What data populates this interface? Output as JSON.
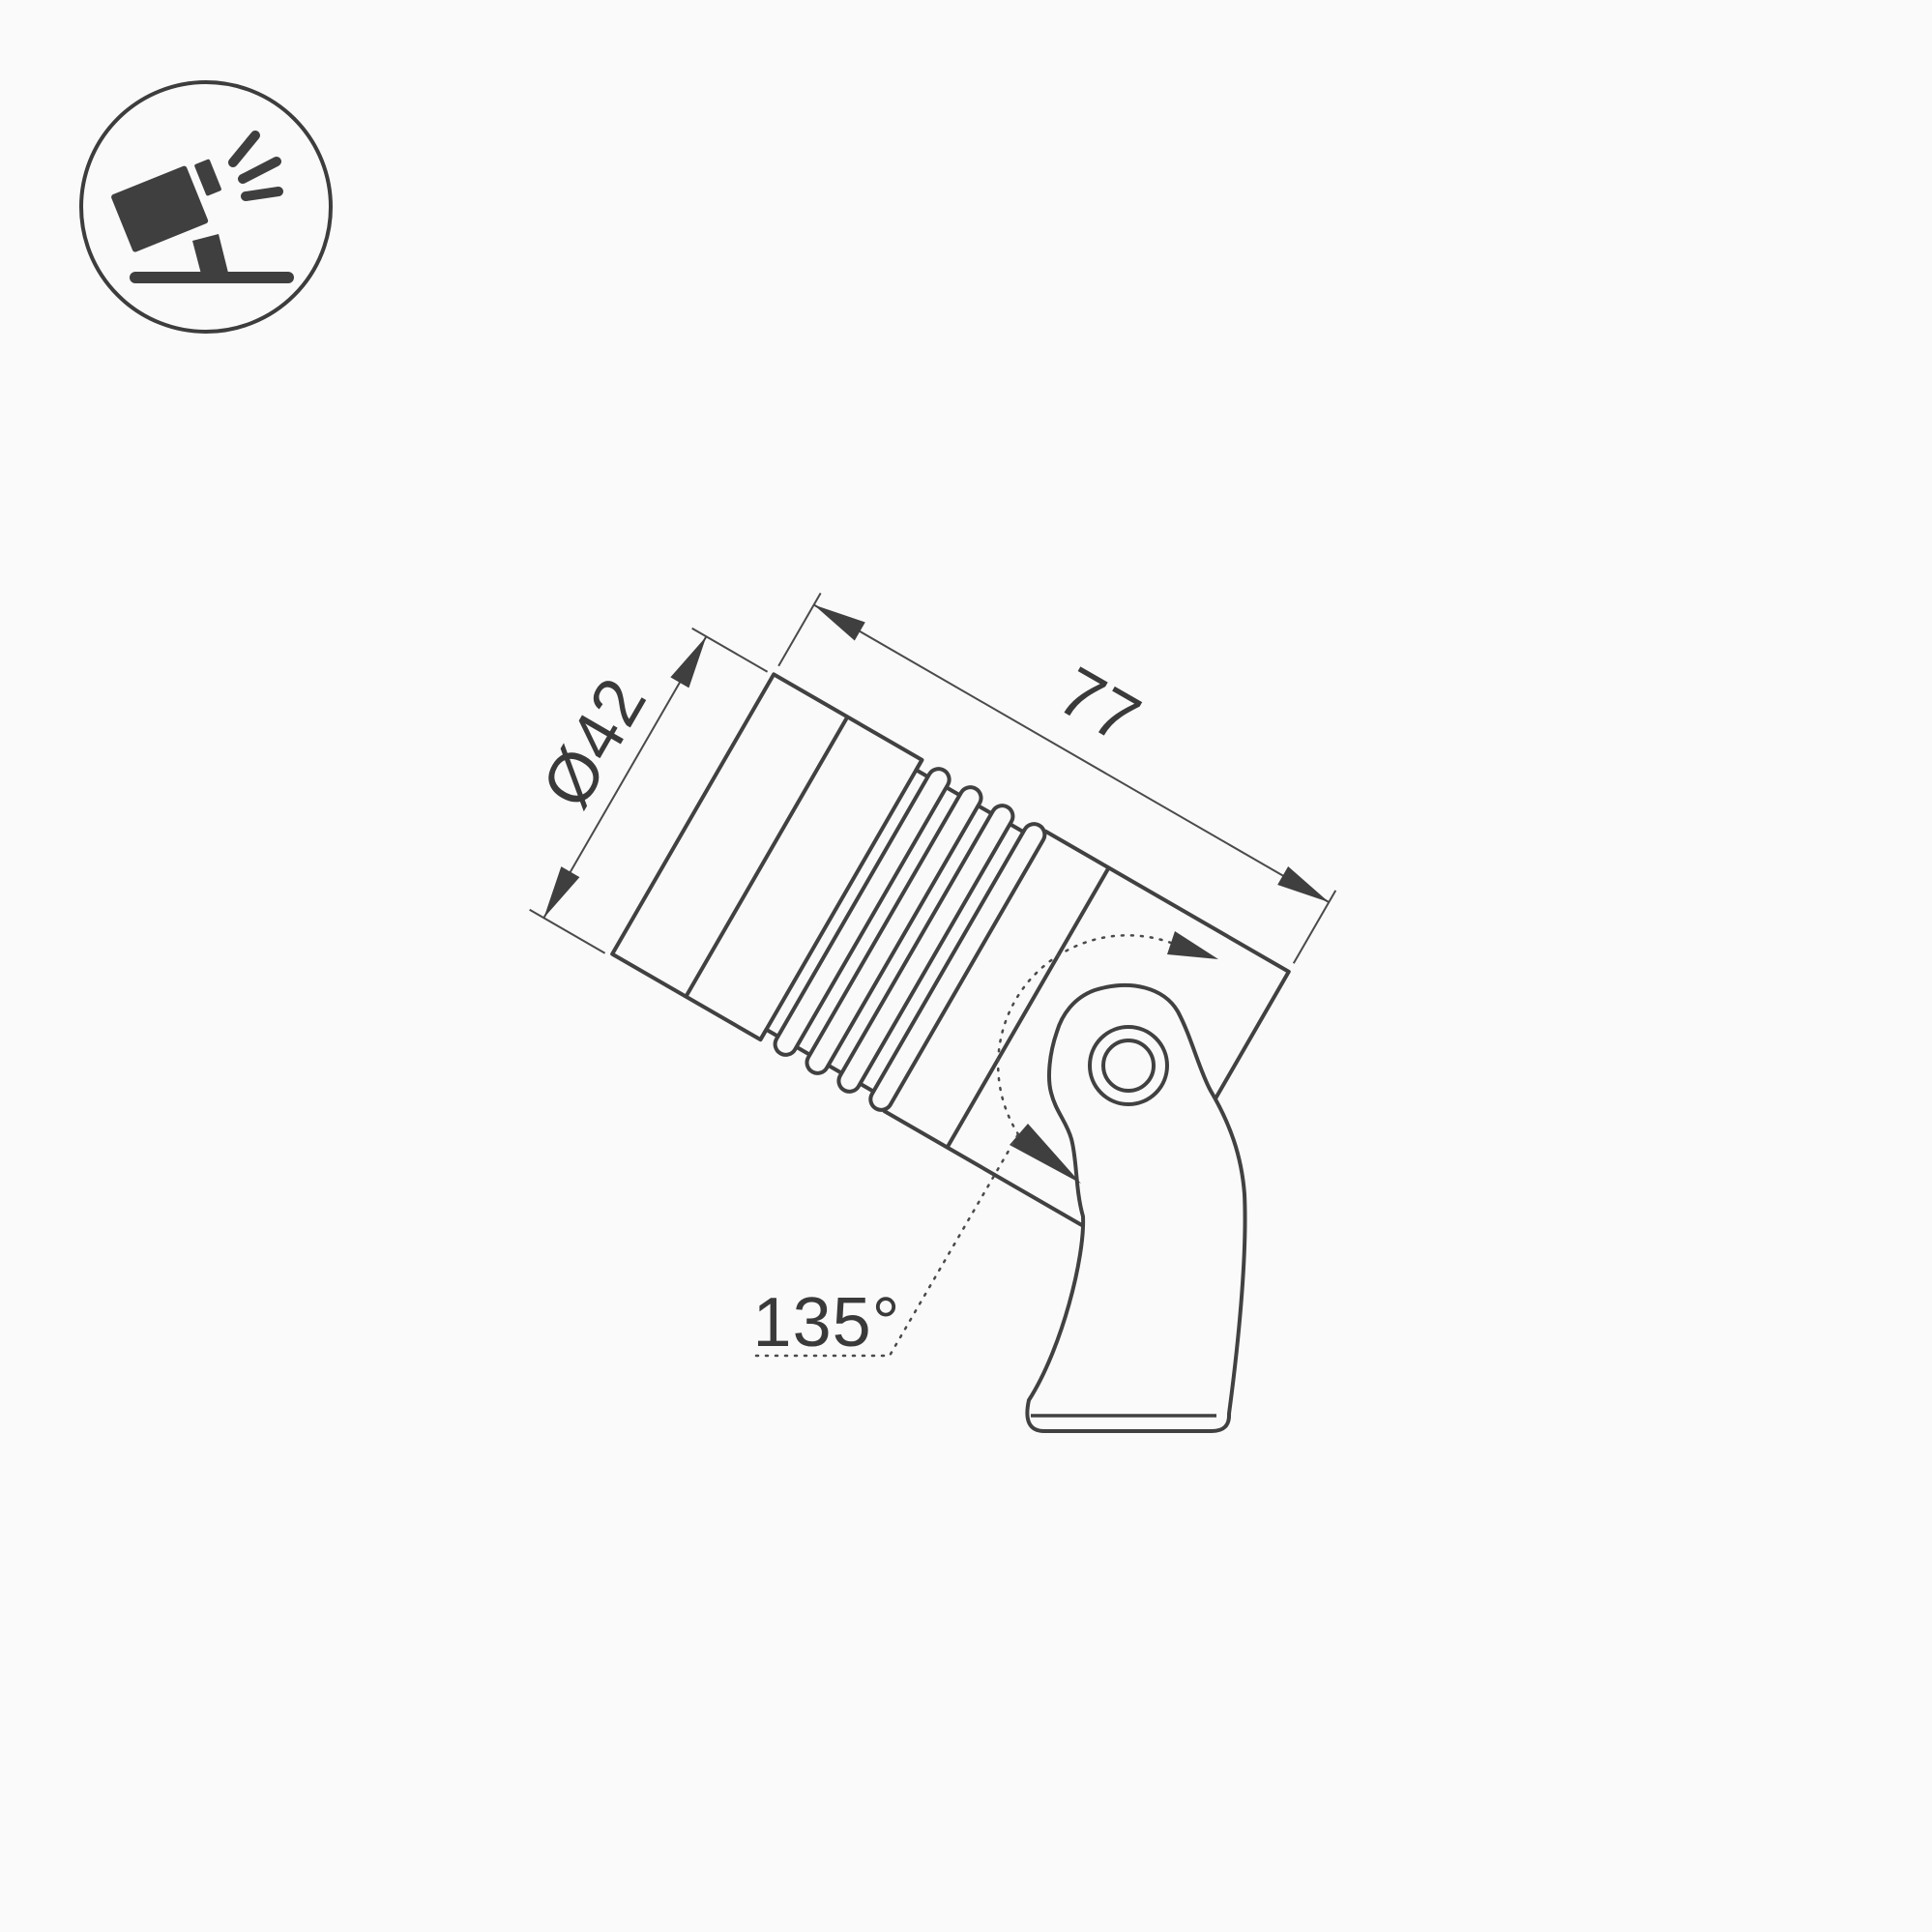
{
  "drawing": {
    "title": "spotlight-dimension-drawing",
    "labels": {
      "diameter": "Ø42",
      "length": "77",
      "angle": "135°"
    },
    "colors": {
      "outline": "#414141",
      "thin_line": "#4a4a4a",
      "arrow_fill": "#3f3f3f",
      "text": "#3a3a3a",
      "background": "#fafafa"
    }
  },
  "icon": {
    "name": "tilted-spotlight-on-stand",
    "shapes": [
      "circle-border",
      "projector-body",
      "lens-cap",
      "light-rays",
      "pole",
      "ground-line"
    ]
  }
}
